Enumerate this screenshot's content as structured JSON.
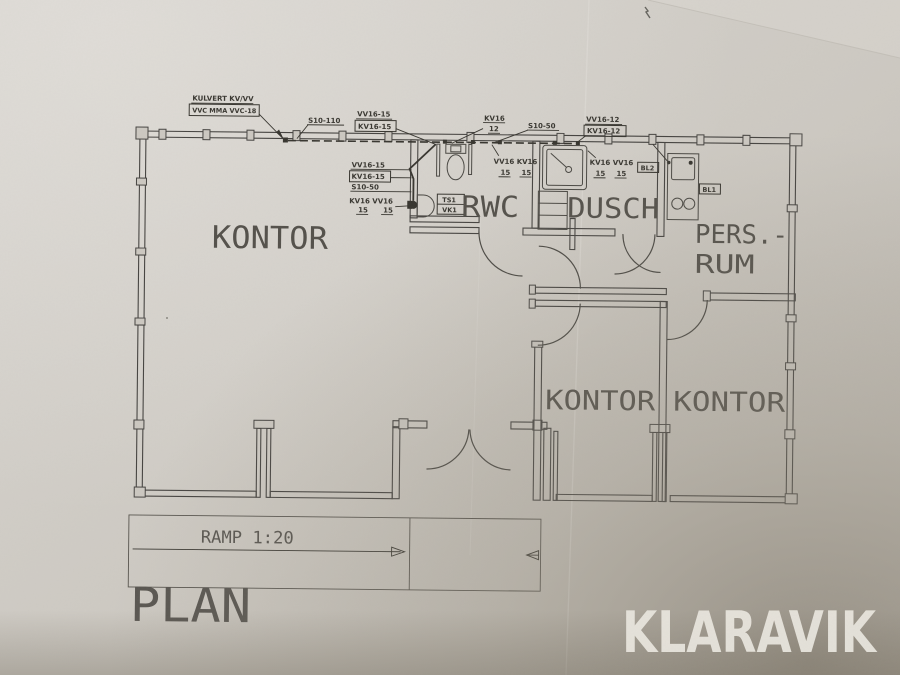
{
  "colors": {
    "paper": "#ccc8c1",
    "paper_light": "#dcd9d4",
    "paper_shadow": "#7d7668",
    "ink": "#454340",
    "watermark_text": "#e9e6de"
  },
  "plan": {
    "title": "PLAN",
    "ramp_label": "RAMP 1:20",
    "rooms": {
      "kontor_main": "KONTOR",
      "rwc": "RWC",
      "dusch": "DUSCH",
      "pers_line1": "PERS.-",
      "pers_line2": "RUM",
      "kontor_mid": "KONTOR",
      "kontor_right": "KONTOR"
    },
    "annotations": {
      "kulvert": "KULVERT KV/VV",
      "vvc": "VVC MMA VVC-18",
      "s10_110": "S10-110",
      "vv16_15": "VV16-15",
      "kv16_15": "KV16-15",
      "kv16": "KV16",
      "n12": "12",
      "s10_50": "S10-50",
      "vv16_12": "VV16-12",
      "kv16_12": "KV16-12",
      "vv16_kv16": "VV16 KV16",
      "kv16_vv16": "KV16 VV16",
      "n15": "15",
      "ts1": "TS1",
      "vk1": "VK1",
      "bl1": "BL1",
      "bl2": "BL2"
    }
  },
  "watermark": {
    "label": "KLARAVIK"
  }
}
